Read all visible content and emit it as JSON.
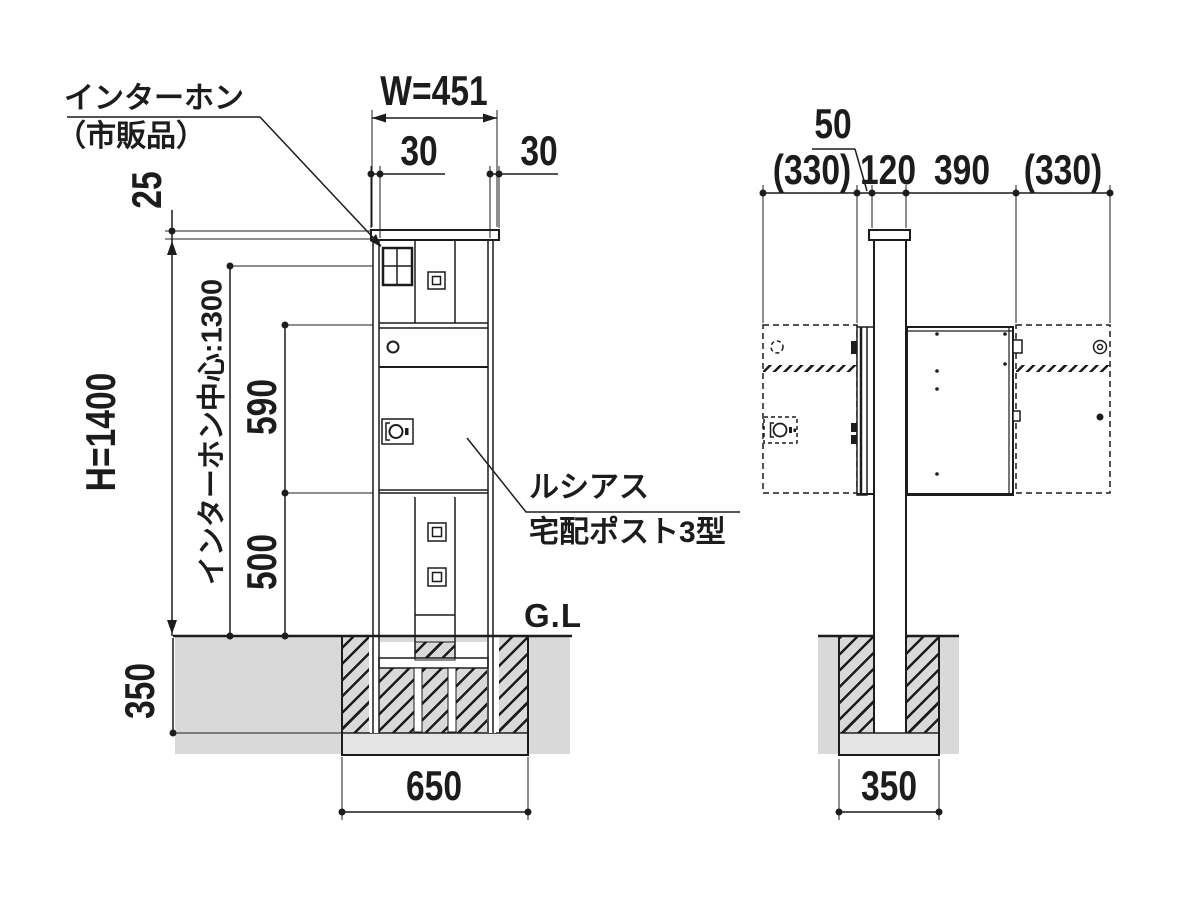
{
  "front_view": {
    "labels": {
      "intercom_line1": "インターホン",
      "intercom_line2": "（市販品）",
      "width_total": "W=451",
      "inset_left": "30",
      "inset_right": "30",
      "cap_offset": "25",
      "height_total": "H=1400",
      "intercom_center": "インターホン中心:1300",
      "upper_door_height": "590",
      "lower_door_height": "500",
      "embed_depth": "350",
      "foundation_width": "650",
      "ground_line": "G.L",
      "product_line1": "ルシアス",
      "product_line2": "宅配ポスト3型"
    }
  },
  "side_view": {
    "labels": {
      "front_gap": "50",
      "door_swing_left": "(330)",
      "pole_depth": "120",
      "body_depth": "390",
      "door_swing_right": "(330)",
      "foundation_width": "350"
    }
  },
  "colors": {
    "line": "#1c1c1c",
    "soil": "#d9d9d9",
    "foundation_base": "#e4e4e4"
  }
}
